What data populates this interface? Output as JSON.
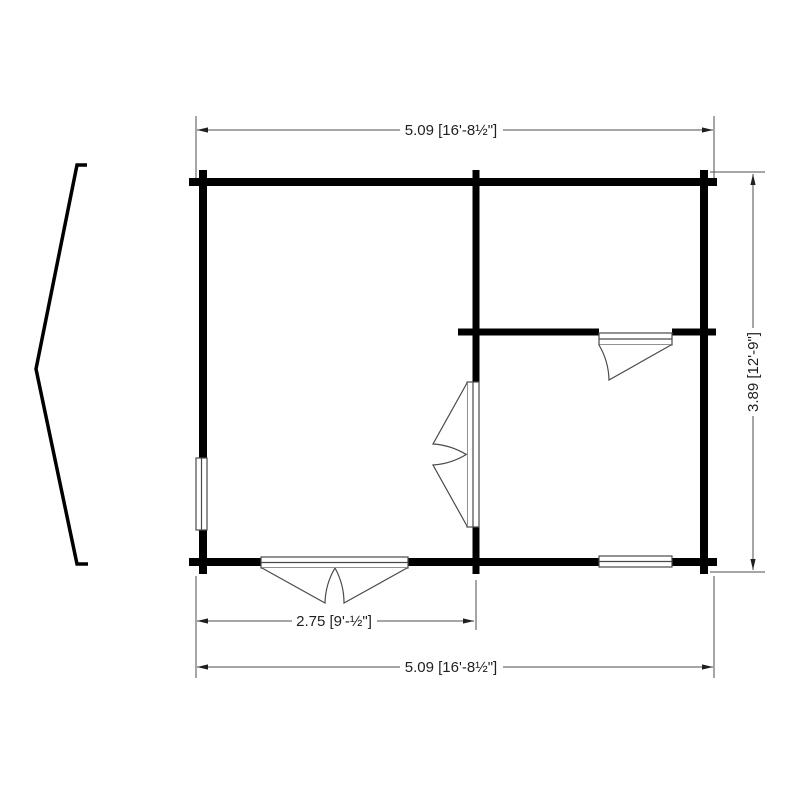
{
  "page": {
    "background": "#ffffff",
    "type": "floor-plan-drawing"
  },
  "drawing": {
    "colors": {
      "wall": "#000000",
      "thin_line": "#4a4a4a",
      "dimension_line": "#4d4d4d",
      "text": "#1f1f1f"
    },
    "dimensions": {
      "top_width": "5.09 [16'-8½\"]",
      "right_height": "3.89 [12'-9\"]",
      "bottom_door_span": "2.75 [9'-½\"]",
      "bottom_width": "5.09 [16'-8½\"]"
    },
    "elements": {
      "roof_profile": "roof-gable-side-profile",
      "front_door": "double-door-swing-out",
      "interior_door": "double-door-swing-left",
      "room_door": "single-door-swing",
      "windows": [
        "window-left-wall",
        "window-bottom-right"
      ]
    }
  }
}
